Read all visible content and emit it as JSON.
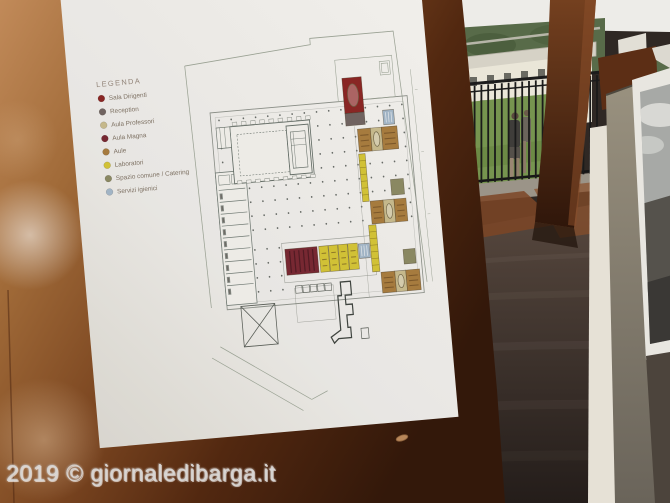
{
  "watermark": {
    "text": "2019 © giornaledibarga.it"
  },
  "poster": {
    "legend": {
      "title": "LEGENDA",
      "items": [
        {
          "label": "Sala Dirigenti",
          "color": "#8a2221"
        },
        {
          "label": "Reception",
          "color": "#6f6360"
        },
        {
          "label": "Aula Professori",
          "color": "#c9bc8e"
        },
        {
          "label": "Aula Magna",
          "color": "#772430"
        },
        {
          "label": "Aule",
          "color": "#a87c3d"
        },
        {
          "label": "Laboratori",
          "color": "#d5c634"
        },
        {
          "label": "Spazio comune / Catering",
          "color": "#8b8a63"
        },
        {
          "label": "Servizi igienici",
          "color": "#a3b8cb"
        }
      ]
    },
    "plan": {
      "rooms": [
        {
          "id": "sala-dirigenti",
          "legend": 0,
          "x": 171,
          "y": 43,
          "w": 21,
          "h": 34,
          "marks": "oval"
        },
        {
          "id": "reception",
          "legend": 1,
          "x": 171,
          "y": 77,
          "w": 21,
          "h": 12
        },
        {
          "id": "wc-1",
          "legend": 7,
          "x": 212,
          "y": 77,
          "w": 12,
          "h": 14,
          "marks": "wc"
        },
        {
          "id": "aula-1",
          "legend": 4,
          "x": 183,
          "y": 93,
          "w": 14,
          "h": 22,
          "marks": "desks"
        },
        {
          "id": "professori-1",
          "legend": 2,
          "x": 197,
          "y": 93,
          "w": 12,
          "h": 22,
          "marks": "oval"
        },
        {
          "id": "aula-2",
          "legend": 4,
          "x": 209,
          "y": 93,
          "w": 17,
          "h": 22,
          "marks": "desks"
        },
        {
          "id": "lab-corridoio-1",
          "legend": 5,
          "x": 182,
          "y": 117,
          "w": 7,
          "h": 46,
          "marks": "cells"
        },
        {
          "id": "spazio-comune-1",
          "legend": 6,
          "x": 214,
          "y": 144,
          "w": 14,
          "h": 15
        },
        {
          "id": "aula-3",
          "legend": 4,
          "x": 190,
          "y": 163,
          "w": 14,
          "h": 22,
          "marks": "desks"
        },
        {
          "id": "professori-2",
          "legend": 2,
          "x": 204,
          "y": 163,
          "w": 12,
          "h": 22,
          "marks": "oval"
        },
        {
          "id": "aula-4",
          "legend": 4,
          "x": 216,
          "y": 163,
          "w": 13,
          "h": 22,
          "marks": "desks"
        },
        {
          "id": "lab-corridoio-2",
          "legend": 5,
          "x": 186,
          "y": 186,
          "w": 8,
          "h": 45,
          "marks": "cells"
        },
        {
          "id": "spazio-comune-2",
          "legend": 6,
          "x": 221,
          "y": 212,
          "w": 13,
          "h": 14
        },
        {
          "id": "aula-5",
          "legend": 4,
          "x": 195,
          "y": 232,
          "w": 15,
          "h": 20,
          "marks": "desks"
        },
        {
          "id": "professori-3",
          "legend": 2,
          "x": 210,
          "y": 232,
          "w": 12,
          "h": 20,
          "marks": "oval"
        },
        {
          "id": "aula-6",
          "legend": 4,
          "x": 222,
          "y": 232,
          "w": 15,
          "h": 20,
          "marks": "desks"
        },
        {
          "id": "aula-magna",
          "legend": 3,
          "x": 93,
          "y": 202,
          "w": 35,
          "h": 25,
          "marks": "rows"
        },
        {
          "id": "laboratorio-1",
          "legend": 5,
          "x": 130,
          "y": 202,
          "w": 10,
          "h": 25,
          "marks": "desks"
        },
        {
          "id": "laboratorio-2",
          "legend": 5,
          "x": 140.5,
          "y": 202,
          "w": 10,
          "h": 25,
          "marks": "desks"
        },
        {
          "id": "laboratorio-3",
          "legend": 5,
          "x": 151,
          "y": 202,
          "w": 10,
          "h": 25,
          "marks": "desks"
        },
        {
          "id": "laboratorio-4",
          "legend": 5,
          "x": 161.5,
          "y": 202,
          "w": 10.5,
          "h": 25,
          "marks": "desks"
        },
        {
          "id": "wc-2",
          "legend": 7,
          "x": 173,
          "y": 203,
          "w": 12,
          "h": 14,
          "marks": "wc"
        }
      ]
    }
  },
  "scene": {
    "colors": {
      "copper_light": "#c18a59",
      "copper_dark": "#33180a",
      "floor_dark": "#332a26",
      "ceiling": "#edecе8",
      "grass": "#76944f",
      "hill": "#586b49",
      "building": "#eae6d8",
      "railing": "#1a1a1a",
      "paper": "#f4f3f0"
    }
  }
}
